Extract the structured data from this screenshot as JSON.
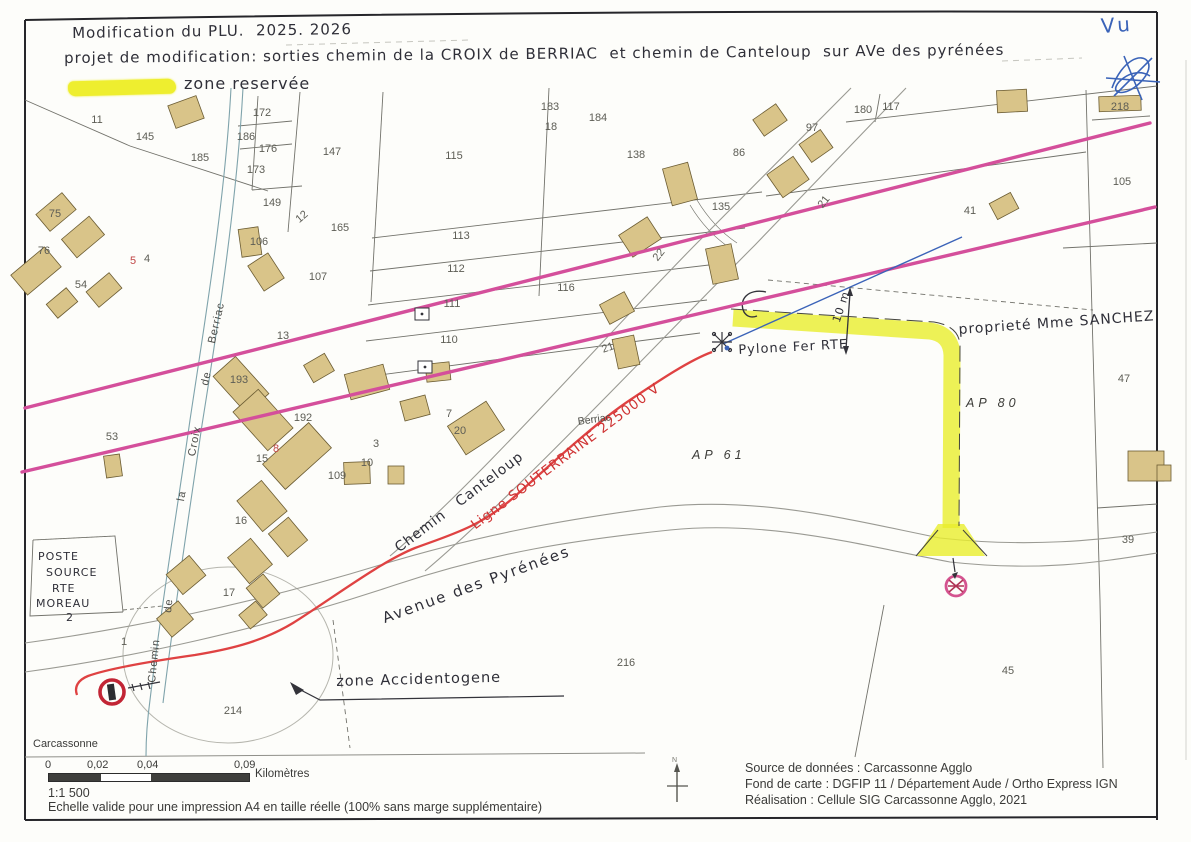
{
  "header": {
    "line1": "Modification du PLU.  2025. 2026",
    "line2": "projet de modification: sorties chemin de la CROIX de BERRIAC  et chemin de Canteloup  sur AVe des pyrénées"
  },
  "legend": {
    "reserved_zone_label": "zone reservée"
  },
  "stamp": {
    "vu": "Vu"
  },
  "map": {
    "labels": {
      "propriete": "proprieté Mme SANCHEZ",
      "pylone": "Pylone Fer RTE",
      "dimension": "10 m",
      "ligne_souterraine": "Ligne SOUTERRAINE 225000 V",
      "chemin_canteloup": "Chemin   Canteloup",
      "avenue": "Avenue des Pyrénées",
      "zone_accidentogene": "zone Accidentogene",
      "berriac": "Berriac",
      "ap61": "AP 61",
      "ap80": "AP 80",
      "carcassonne": "Carcassonne",
      "poste_source": [
        "POSTE",
        "SOURCE",
        "RTE",
        "MOREAU",
        "2"
      ],
      "croix_words": [
        "Chemin",
        "de",
        "la",
        "Croix",
        "de",
        "Berriac"
      ]
    },
    "parcels": [
      {
        "t": "11",
        "x": 97,
        "y": 120
      },
      {
        "t": "145",
        "x": 145,
        "y": 137
      },
      {
        "t": "172",
        "x": 262,
        "y": 113
      },
      {
        "t": "186",
        "x": 246,
        "y": 137
      },
      {
        "t": "176",
        "x": 268,
        "y": 149
      },
      {
        "t": "173",
        "x": 256,
        "y": 170
      },
      {
        "t": "185",
        "x": 200,
        "y": 158
      },
      {
        "t": "147",
        "x": 332,
        "y": 152
      },
      {
        "t": "183",
        "x": 550,
        "y": 107
      },
      {
        "t": "184",
        "x": 598,
        "y": 118
      },
      {
        "t": "18",
        "x": 551,
        "y": 127
      },
      {
        "t": "115",
        "x": 454,
        "y": 156
      },
      {
        "t": "138",
        "x": 636,
        "y": 155
      },
      {
        "t": "86",
        "x": 739,
        "y": 153
      },
      {
        "t": "97",
        "x": 812,
        "y": 128
      },
      {
        "t": "180",
        "x": 863,
        "y": 110
      },
      {
        "t": "117",
        "x": 891,
        "y": 107
      },
      {
        "t": "135",
        "x": 721,
        "y": 207
      },
      {
        "t": "41",
        "x": 970,
        "y": 211
      },
      {
        "t": "218",
        "x": 1120,
        "y": 107
      },
      {
        "t": "105",
        "x": 1122,
        "y": 182
      },
      {
        "t": "149",
        "x": 272,
        "y": 203
      },
      {
        "t": "12",
        "x": 302,
        "y": 217,
        "r": -40
      },
      {
        "t": "165",
        "x": 340,
        "y": 228
      },
      {
        "t": "106",
        "x": 259,
        "y": 242
      },
      {
        "t": "107",
        "x": 318,
        "y": 277
      },
      {
        "t": "113",
        "x": 461,
        "y": 236
      },
      {
        "t": "112",
        "x": 456,
        "y": 269
      },
      {
        "t": "111",
        "x": 452,
        "y": 304
      },
      {
        "t": "110",
        "x": 449,
        "y": 340
      },
      {
        "t": "116",
        "x": 566,
        "y": 288
      },
      {
        "t": "13",
        "x": 283,
        "y": 336
      },
      {
        "t": "193",
        "x": 239,
        "y": 380
      },
      {
        "t": "192",
        "x": 303,
        "y": 418
      },
      {
        "t": "53",
        "x": 112,
        "y": 437
      },
      {
        "t": "75",
        "x": 55,
        "y": 214
      },
      {
        "t": "76",
        "x": 44,
        "y": 251
      },
      {
        "t": "5",
        "x": 133,
        "y": 261,
        "c": "red"
      },
      {
        "t": "4",
        "x": 147,
        "y": 259
      },
      {
        "t": "54",
        "x": 81,
        "y": 285
      },
      {
        "t": "8",
        "x": 276,
        "y": 449,
        "c": "red"
      },
      {
        "t": "15",
        "x": 262,
        "y": 459
      },
      {
        "t": "109",
        "x": 337,
        "y": 476
      },
      {
        "t": "3",
        "x": 376,
        "y": 444
      },
      {
        "t": "10",
        "x": 367,
        "y": 463
      },
      {
        "t": "7",
        "x": 449,
        "y": 414
      },
      {
        "t": "20",
        "x": 460,
        "y": 431
      },
      {
        "t": "16",
        "x": 241,
        "y": 521
      },
      {
        "t": "17",
        "x": 229,
        "y": 593
      },
      {
        "t": "1",
        "x": 124,
        "y": 642
      },
      {
        "t": "21",
        "x": 608,
        "y": 348,
        "r": -20
      },
      {
        "t": "22",
        "x": 659,
        "y": 255,
        "r": -52
      },
      {
        "t": "21",
        "x": 824,
        "y": 202,
        "r": -52
      },
      {
        "t": "47",
        "x": 1124,
        "y": 379
      },
      {
        "t": "39",
        "x": 1128,
        "y": 540
      },
      {
        "t": "214",
        "x": 233,
        "y": 711
      },
      {
        "t": "216",
        "x": 626,
        "y": 663
      },
      {
        "t": "45",
        "x": 1008,
        "y": 671
      }
    ]
  },
  "footer": {
    "scalebar": {
      "ticks": [
        "0",
        "0,02",
        "0,04",
        "0,09"
      ],
      "unit": "Kilomètres",
      "ratio": "1:1 500",
      "note": "Echelle valide pour une impression A4 en taille réelle (100% sans marge supplémentaire)"
    },
    "credits": [
      "Source de données : Carcassonne Agglo",
      "Fond de carte : DGFIP 11 / Département Aude / Ortho Express IGN",
      "Réalisation : Cellule SIG Carcassonne Agglo, 2021"
    ]
  },
  "colors": {
    "highlight_yellow": "#e9ee2d",
    "line_pink": "#d44f9b",
    "line_red": "#df4242",
    "line_blue": "#3b63b8",
    "building_tan": "#d9c489",
    "ink": "#2f2f38"
  }
}
